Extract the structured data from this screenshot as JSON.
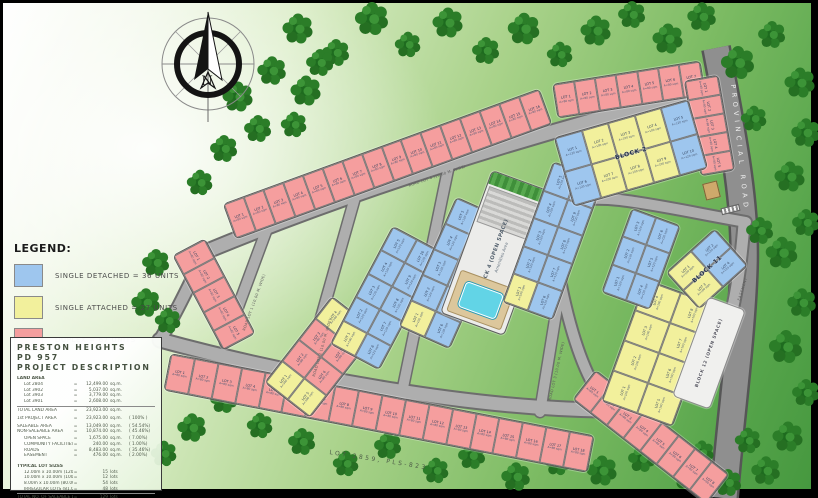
{
  "legend": {
    "heading": "LEGEND:",
    "items": [
      {
        "type": "single_detached",
        "color": "#9ec6ee",
        "label": "SINGLE DETACHED = 36 UNITS"
      },
      {
        "type": "single_attached",
        "color": "#f2f09c",
        "label": "SINGLE ATTACHED = 27 UNITS"
      },
      {
        "type": "duplex",
        "color": "#f59e9e",
        "label": "DUPLEX = 67 UNITS"
      }
    ]
  },
  "project": {
    "name1": "PRESTON HEIGHTS",
    "name2": "PD 957",
    "name3": "PROJECT DESCRIPTION",
    "rows": [
      {
        "t": "h",
        "l": "LAND AREA"
      },
      {
        "t": "r",
        "i": 1,
        "l": "Lot 2804",
        "v": "12,499.00",
        "u": "sq.m."
      },
      {
        "t": "r",
        "i": 1,
        "l": "Lot 3902",
        "v": "5,037.00",
        "u": "sq.m."
      },
      {
        "t": "r",
        "i": 1,
        "l": "Lot 3903",
        "v": "3,779.00",
        "u": "sq.m."
      },
      {
        "t": "r",
        "i": 1,
        "l": "Lot 3901",
        "v": "2,608.00",
        "u": "sq.m."
      },
      {
        "t": "t",
        "l": "TOTAL LAND AREA",
        "v": "23,923.00",
        "u": "sq.m."
      },
      {
        "t": "gap"
      },
      {
        "t": "r",
        "l": "1st PROJECT AREA",
        "v": "23,923.00",
        "u": "sq.m.",
        "p": "( 100% )"
      },
      {
        "t": "gap2"
      },
      {
        "t": "r",
        "l": "SALEABLE AREA",
        "v": "13,049.00",
        "u": "sq.m.",
        "p": "( 54.54%)"
      },
      {
        "t": "r",
        "l": "NON-SALEABLE AREA",
        "v": "10,874.00",
        "u": "sq.m.",
        "p": "( 45.46%)"
      },
      {
        "t": "gap2"
      },
      {
        "t": "r",
        "i": 1,
        "l": "OPEN SPACE",
        "v": "1,675.00",
        "u": "sq.m.",
        "p": "( 7.00%)"
      },
      {
        "t": "r",
        "i": 1,
        "l": "COMMUNITY FACILITIES",
        "v": "240.00",
        "u": "sq.m.",
        "p": "( 1.00%)"
      },
      {
        "t": "r",
        "i": 1,
        "l": "ROADS",
        "v": "8,483.00",
        "u": "sq.m.",
        "p": "( 35.46%)"
      },
      {
        "t": "r",
        "i": 1,
        "l": "EASEMENT",
        "v": "476.00",
        "u": "sq.m.",
        "p": "( 2.00%)"
      },
      {
        "t": "gap"
      },
      {
        "t": "h",
        "l": "TYPICAL LOT SIZES"
      },
      {
        "t": "r",
        "i": 1,
        "l": "12.00m x 10.00m (120.00 sq.m.)",
        "v": "15",
        "u": "lots"
      },
      {
        "t": "r",
        "i": 1,
        "l": "10.00m x 10.00m (100.00 sq.m.)",
        "v": "12",
        "u": "lots"
      },
      {
        "t": "r",
        "i": 1,
        "l": "8.00m x 10.00m (80.00 sq.m.)",
        "v": "54",
        "u": "lots"
      },
      {
        "t": "r",
        "i": 1,
        "l": "IRREGULAR LOTS (81.00 - 167 sq.m.)",
        "v": "48",
        "u": "lots"
      },
      {
        "t": "t",
        "l": "TOTAL NO. OF SALEABLE LOTS",
        "v": "129",
        "u": "lots"
      }
    ]
  },
  "map": {
    "labels": {
      "north": "N",
      "provincial_road": "PROVINCIAL ROAD",
      "mother_lot": "LOT 2859, PLS-823",
      "easement": "EASEMENT",
      "amenity_block": "BLOCK 4 (OPEN SPACE)",
      "amenity_sub": "Amenities Area"
    },
    "lot_prefix": "LOT",
    "lot_area_text": {
      "d": "A=120 sqm",
      "a": "A=100 sqm",
      "x": "A=80 sqm"
    },
    "colors": {
      "detached": "#9ec6ee",
      "attached": "#f2f09c",
      "duplex": "#f59e9e",
      "road": "#aeaeae",
      "pool": "#62d4e6",
      "tree_dark": "#1e6b1f",
      "tree_mid": "#2b7d28",
      "tree_light": "#3c9437"
    },
    "road_names": [
      {
        "text": "ROAD LOT 1 (10.00 M. WIDE)",
        "x": 242,
        "y": 330,
        "rot": -70
      },
      {
        "text": "ROAD LOT 2 (10.00 M. WIDE)",
        "x": 312,
        "y": 376,
        "rot": -74
      },
      {
        "text": "ROAD LOT 3 (10.00 M. WIDE)",
        "x": 548,
        "y": 400,
        "rot": -77
      },
      {
        "text": "ROAD LOT 4 (10.00 M. WIDE)",
        "x": 408,
        "y": 184,
        "rot": -19
      }
    ],
    "strips": [
      {
        "name": "strip-top-duplex-row",
        "cx": 386,
        "cy": 163,
        "len": 335,
        "dep": 36,
        "rot": -20,
        "rows": [
          "xxxxxxxxxxxxxxxx"
        ]
      },
      {
        "name": "strip-topright-duplex-row",
        "cx": 628,
        "cy": 88,
        "len": 148,
        "dep": 33,
        "rot": -9,
        "rows": [
          "xxxxxxx"
        ]
      },
      {
        "name": "strip-right-duplex-row",
        "cx": 708,
        "cy": 124,
        "len": 95,
        "dep": 33,
        "rot": 80,
        "rows": [
          "xxxxx"
        ]
      },
      {
        "name": "strip-left-duplex-row",
        "cx": 213,
        "cy": 293,
        "len": 106,
        "dep": 35,
        "rot": 62,
        "rows": [
          "xxxxx"
        ]
      },
      {
        "name": "strip-bottom-duplex-row",
        "cx": 378,
        "cy": 412,
        "len": 430,
        "dep": 36,
        "rot": 11,
        "rows": [
          "xxxxxxxxxxxxxxxxxx"
        ]
      },
      {
        "name": "strip-bottomright-duplex-row",
        "cx": 650,
        "cy": 436,
        "len": 168,
        "dep": 36,
        "rot": 38,
        "rows": [
          "xxxxxxxx"
        ]
      },
      {
        "name": "block-5",
        "cx": 320,
        "cy": 356,
        "len": 108,
        "dep": 56,
        "rot": -52,
        "rows": [
          "axxa",
          "axxa"
        ]
      },
      {
        "name": "block-6",
        "cx": 385,
        "cy": 297,
        "len": 132,
        "dep": 54,
        "rot": -62,
        "rows": [
          "adddd",
          "ddddd"
        ]
      },
      {
        "name": "block-7",
        "cx": 452,
        "cy": 272,
        "len": 140,
        "dep": 54,
        "rot": -66,
        "rows": [
          "adddd",
          "ddddd"
        ]
      },
      {
        "name": "block-4-open-space",
        "cx": 497,
        "cy": 252,
        "len": 150,
        "dep": 66,
        "rot": -70,
        "kind": "amenity"
      },
      {
        "name": "block-3",
        "cx": 552,
        "cy": 240,
        "len": 148,
        "dep": 52,
        "rot": -70,
        "rows": [
          "adddd",
          "ddddd"
        ]
      },
      {
        "name": "block-2",
        "cx": 630,
        "cy": 152,
        "len": 138,
        "dep": 70,
        "rot": -16,
        "rows": [
          "daaad",
          "daaad"
        ],
        "label": "BLOCK 2"
      },
      {
        "name": "block-9",
        "cx": 658,
        "cy": 352,
        "len": 128,
        "dep": 74,
        "rot": -70,
        "rows": [
          "aaaa",
          "aaaa"
        ]
      },
      {
        "name": "block-10",
        "cx": 640,
        "cy": 258,
        "len": 88,
        "dep": 50,
        "rot": -70,
        "rows": [
          "ddd",
          "ddd"
        ]
      },
      {
        "name": "block-11",
        "cx": 706,
        "cy": 268,
        "len": 64,
        "dep": 48,
        "rot": -42,
        "rows": [
          "ad",
          "ad"
        ],
        "label": "BLOCK 11"
      },
      {
        "name": "block-12-open-space",
        "cx": 708,
        "cy": 352,
        "len": 104,
        "dep": 38,
        "rot": -70,
        "kind": "open",
        "label": "BLOCK 12 (OPEN SPACE)"
      }
    ],
    "trees": [
      [
        298,
        28,
        1
      ],
      [
        336,
        52,
        0.9
      ],
      [
        372,
        18,
        1.1
      ],
      [
        408,
        44,
        0.85
      ],
      [
        448,
        22,
        1
      ],
      [
        486,
        50,
        0.9
      ],
      [
        524,
        28,
        1.05
      ],
      [
        560,
        54,
        0.85
      ],
      [
        596,
        30,
        1
      ],
      [
        632,
        14,
        0.9
      ],
      [
        668,
        38,
        1
      ],
      [
        702,
        16,
        0.95
      ],
      [
        738,
        62,
        1.1
      ],
      [
        772,
        34,
        0.9
      ],
      [
        800,
        82,
        1
      ],
      [
        806,
        132,
        0.95
      ],
      [
        790,
        176,
        1
      ],
      [
        806,
        222,
        0.9
      ],
      [
        782,
        252,
        1.05
      ],
      [
        802,
        302,
        0.95
      ],
      [
        786,
        346,
        1.1
      ],
      [
        806,
        392,
        0.9
      ],
      [
        788,
        436,
        1
      ],
      [
        766,
        470,
        0.95
      ],
      [
        728,
        482,
        0.9
      ],
      [
        688,
        474,
        1
      ],
      [
        642,
        458,
        0.9
      ],
      [
        602,
        470,
        1
      ],
      [
        558,
        462,
        0.85
      ],
      [
        516,
        476,
        0.95
      ],
      [
        472,
        455,
        0.9
      ],
      [
        436,
        470,
        0.85
      ],
      [
        388,
        445,
        0.9
      ],
      [
        346,
        463,
        0.85
      ],
      [
        302,
        441,
        0.9
      ],
      [
        260,
        425,
        0.85
      ],
      [
        224,
        399,
        0.9
      ],
      [
        192,
        427,
        0.95
      ],
      [
        164,
        453,
        0.85
      ],
      [
        156,
        262,
        0.9
      ],
      [
        146,
        302,
        0.95
      ],
      [
        168,
        320,
        0.85
      ],
      [
        238,
        96,
        1
      ],
      [
        272,
        70,
        0.95
      ],
      [
        306,
        90,
        1
      ],
      [
        258,
        128,
        0.9
      ],
      [
        294,
        124,
        0.85
      ],
      [
        224,
        148,
        0.9
      ],
      [
        320,
        62,
        0.9
      ],
      [
        200,
        182,
        0.85
      ],
      [
        696,
        122,
        0.8
      ],
      [
        706,
        160,
        0.75
      ],
      [
        754,
        118,
        0.85
      ],
      [
        760,
        230,
        0.9
      ],
      [
        748,
        440,
        0.85
      ],
      [
        702,
        452,
        0.8
      ]
    ]
  }
}
